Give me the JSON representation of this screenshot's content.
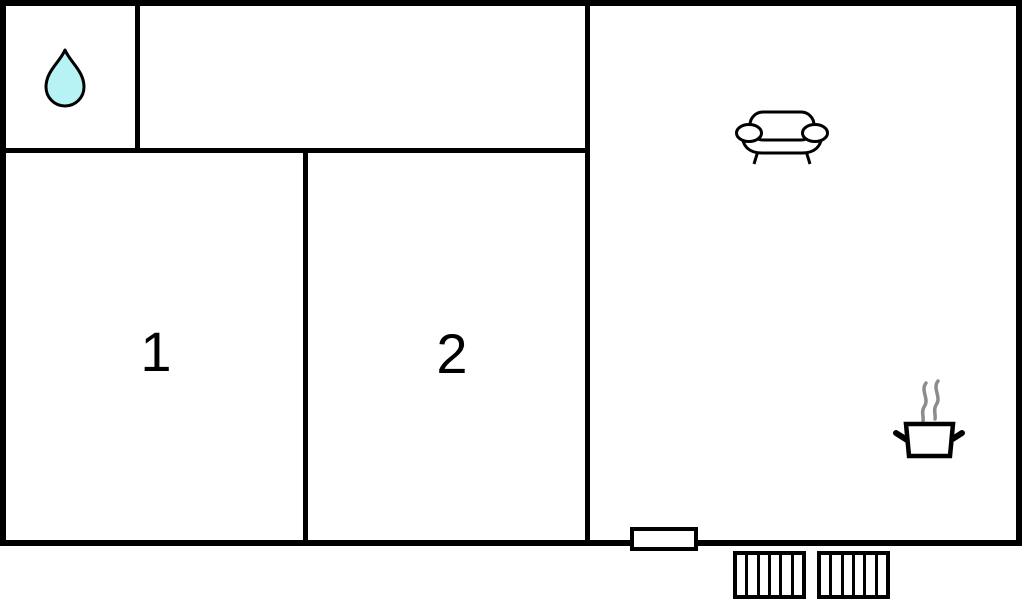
{
  "floorplan": {
    "labels": {
      "room1": "1",
      "room2": "2"
    },
    "icons": [
      "water-drop-icon",
      "sofa-icon",
      "cooking-pot-icon",
      "steam-lines-icon"
    ],
    "colors": {
      "wall": "#000000",
      "background": "#ffffff",
      "water_drop_fill": "#b7f2f4",
      "outline": "#000000",
      "steam": "#8c8c8c"
    },
    "fixtures": {
      "window_count": 1,
      "stairs_sections": 2,
      "stairs_treads_per_section": 6
    }
  }
}
